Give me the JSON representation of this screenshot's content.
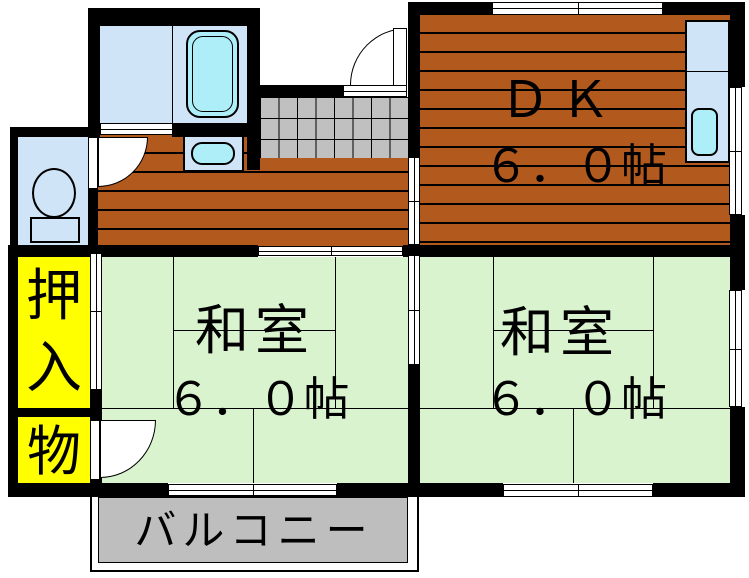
{
  "floor_plan": {
    "rooms": {
      "dk": {
        "name": "ＤＫ",
        "size": "６．０帖"
      },
      "japanese_room_left": {
        "name": "和室",
        "size": "６．０帖"
      },
      "japanese_room_right": {
        "name": "和室",
        "size": "６．０帖"
      },
      "closet": {
        "char_top": "押",
        "char_bottom": "入"
      },
      "storage": {
        "name": "物"
      },
      "balcony": {
        "name": "バルコニー"
      }
    },
    "colors": {
      "wall": "#000000",
      "wood_floor": "#B2591E",
      "tatami": "#D9F3CF",
      "room_blue": "#CFE4F7",
      "fixture_cyan": "#AEEEF8",
      "closet_yellow": "#FFFF00",
      "tile_gray": "#C0C0C0",
      "balcony_gray": "#BEBEBE",
      "background": "#FFFFFF"
    }
  }
}
